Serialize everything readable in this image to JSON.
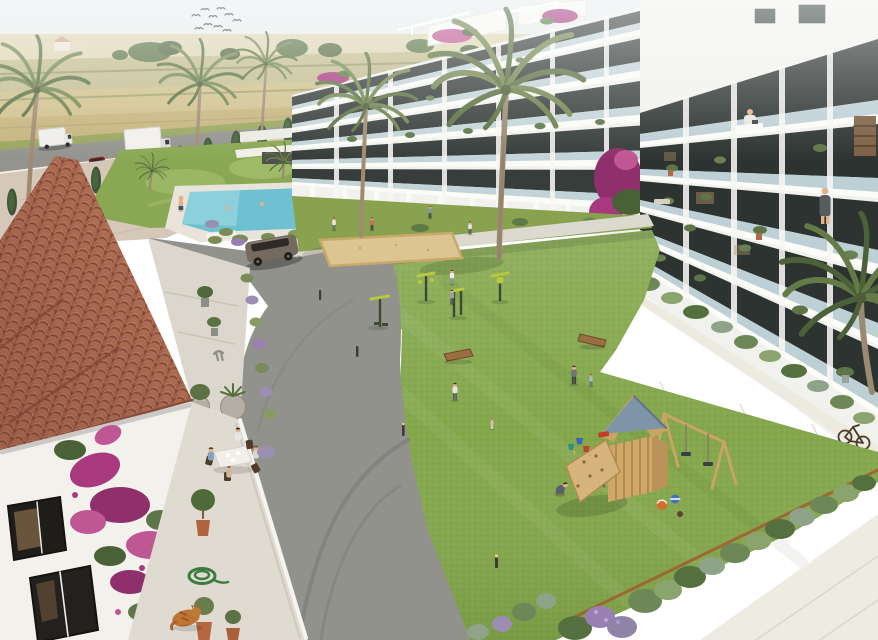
{
  "scene": {
    "title": "Aerial 3D render of a new-build Mediterranean apartment complex with landscaped courtyard, pool and playground",
    "sky": {
      "style": "hazy pale blue",
      "birds": 10
    },
    "background": {
      "fields": "golden farm fields",
      "farmhouse": "distant farmhouse",
      "road": "perimeter road",
      "vehicles": [
        "white camper van",
        "white box truck",
        "red car"
      ],
      "hedge": "cypress tree row",
      "fence": "white rail fence"
    },
    "pool_area": {
      "pool": "turquoise pool",
      "swimmers": 2,
      "poolside_person": 1,
      "features": [
        "white garden walls",
        "palm planter box",
        "sun loungers",
        "ornamental grasses",
        "decorative mown lawn"
      ]
    },
    "left_building": {
      "type": "white apartment block",
      "floors": 5,
      "features": [
        "glass balconies",
        "rooftop pergola terraces",
        "bougainvillea",
        "curved privacy fins"
      ]
    },
    "right_building": {
      "type": "white apartment block",
      "floors": 6,
      "residents": [
        "person working at desk",
        "person standing at railing"
      ],
      "features": [
        "deep balconies with potted plants",
        "bookshelf wall",
        "stepped garden planters",
        "white walkway"
      ],
      "bicycle": 1
    },
    "courtyard": {
      "lawn": "large sunlit lawn",
      "sand_pit": 1,
      "outdoor_gym_stations": 4,
      "play_tower": "wooden tower with blue roof, climbing ramp and double swing",
      "toys": [
        "orange ball",
        "blue ball",
        "buckets",
        "red toy truck"
      ],
      "benches": 2,
      "bollard_lights": 4,
      "people": [
        "jogger",
        "walkers on path",
        "mother with toddler",
        "parent with child",
        "crouching boy",
        "toddler",
        "walker near steps"
      ]
    },
    "foreground_house": {
      "roof": "terracotta barrel tile roof",
      "walls": "white plaster with dark-framed windows",
      "bougainvillea": "magenta climbing bougainvillea",
      "terrace": {
        "diners": 4,
        "table": "white dining table",
        "plants": [
          "potted olive trees",
          "round stone planters",
          "lavender border"
        ],
        "hose": "coiled green garden hose",
        "cat": "sleeping ginger cat"
      },
      "statue": "small grey garden sculpture"
    },
    "driveway": {
      "surface": "asphalt with tyre marks",
      "suv": "parked grey SUV"
    },
    "bottom_right": {
      "border": "shrub and lavender border with corten edge",
      "pavement": "white walkway corner"
    },
    "palette": {
      "lawn": "#84a74c",
      "deco_lawn": "#8aa854",
      "road": "#92928d",
      "pool": "#6fc0d1",
      "sand": "#dbc591",
      "building": "#f1f2ee",
      "glass": "#c3d4d8",
      "window": "#2e3331",
      "roof_terracotta": "#b26b52",
      "play_roof": "#7e95a9",
      "play_wood": "#c9a463",
      "bougainvillea": "#a8397f",
      "lavender": "#9a7fb5",
      "shrub": "#6d8756",
      "field_gold": "#cdbd84",
      "cat": "#bd7434"
    }
  }
}
